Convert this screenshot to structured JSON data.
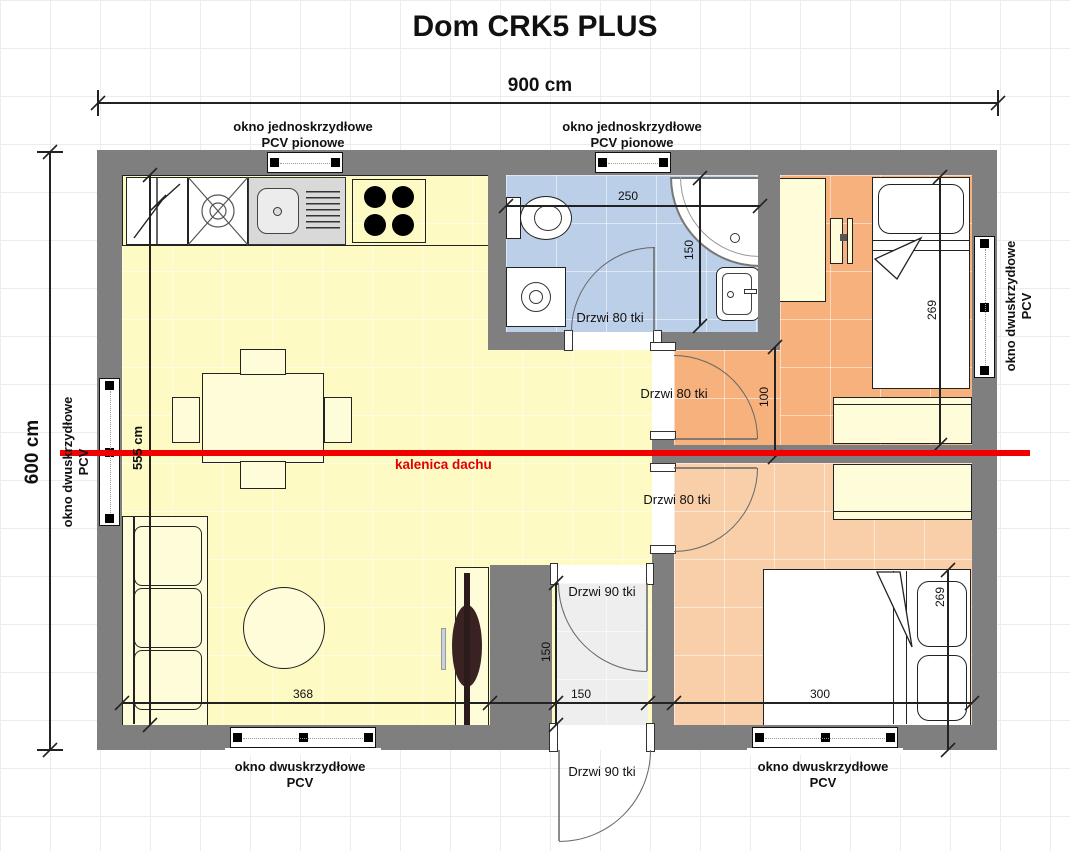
{
  "title": "Dom CRK5 PLUS",
  "dimensions": {
    "total_width": "900 cm",
    "total_height": "600 cm",
    "living_height": "555 cm",
    "bathroom_width": "250",
    "bathroom_depth": "150",
    "door_offset": "100",
    "bed_top_length": "269",
    "bed_bottom_length": "269",
    "bedroom_bottom_width": "300",
    "living_width": "368",
    "hall_width": "150",
    "hall_depth": "150"
  },
  "labels": {
    "ridge": "kalenica dachu",
    "window_single_1": "okno jednoskrzydłowe",
    "window_single_2": "PCV pionowe",
    "window_double_1": "okno dwuskrzydłowe",
    "window_double_2": "PCV",
    "door_80": "Drzwi 80 tki",
    "door_90": "Drzwi 90 tki"
  },
  "colors": {
    "wall": "#7f7f7f",
    "living_room": "#fdfac4",
    "bathroom": "#bccfe8",
    "bedroom_top": "#f6b17c",
    "bedroom_bottom": "#f9cfa9",
    "hall": "#eeeeee",
    "furniture": "#fefcd9",
    "ridge_red": "#f10000"
  }
}
